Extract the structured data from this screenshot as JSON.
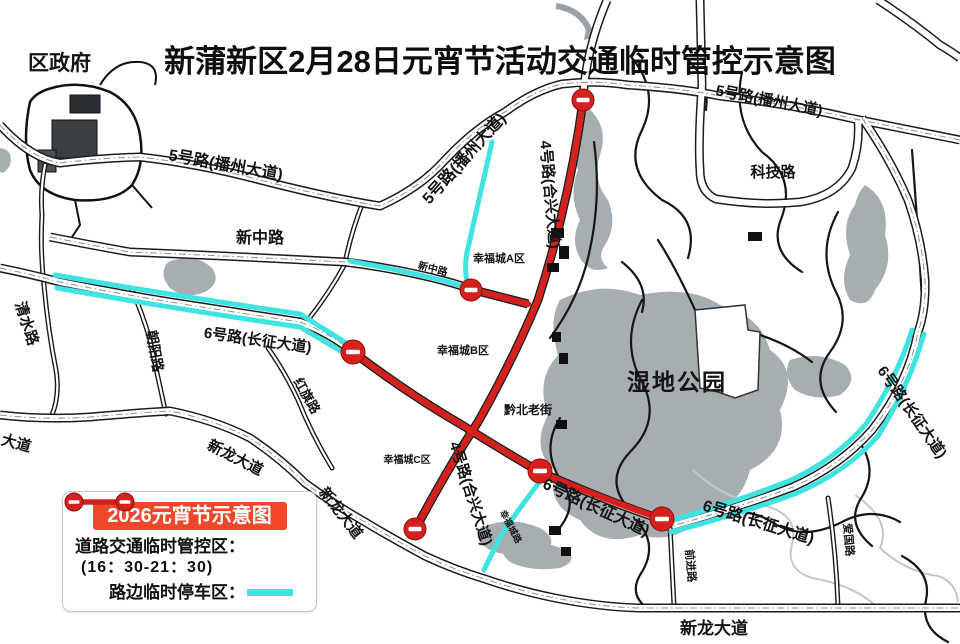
{
  "title": "新蒲新区2月28日元宵节活动交通临时管控示意图",
  "legend": {
    "header": "2026元宵节示意图",
    "control_label": "道路交通临时管控区：",
    "control_time": "(16：30-21：30)",
    "parking_label": "路边临时停车区："
  },
  "colors": {
    "control_red": "#d5201d",
    "parking_cyan": "#3fe3e0",
    "legend_header_bg": "#f0472b",
    "water_gray": "#a7aeb2"
  },
  "map": {
    "labels": {
      "district_government": "区政府",
      "road_5": "5号路(播州大道)",
      "keji_road": "科技路",
      "xinzhong_road": "新中路",
      "qingshui_road": "清水路",
      "chaoyang_road": "朝阳路",
      "hongqi_road": "红旗路",
      "road_6": "6号路(长征大道)",
      "road_4": "4号路(合兴大道)",
      "xingfucheng_a": "幸福城A区",
      "xingfucheng_b": "幸福城B区",
      "xingfucheng_c": "幸福城C区",
      "xingfucheng_road": "幸福城路",
      "qianbei_old_street": "黔北老街",
      "wetland_park": "湿地公园",
      "qianjin_road": "前进路",
      "aiguo_road": "爱国路",
      "xinlong_avenue": "新龙大道",
      "xinlong_avenue_partial": "大道"
    }
  }
}
